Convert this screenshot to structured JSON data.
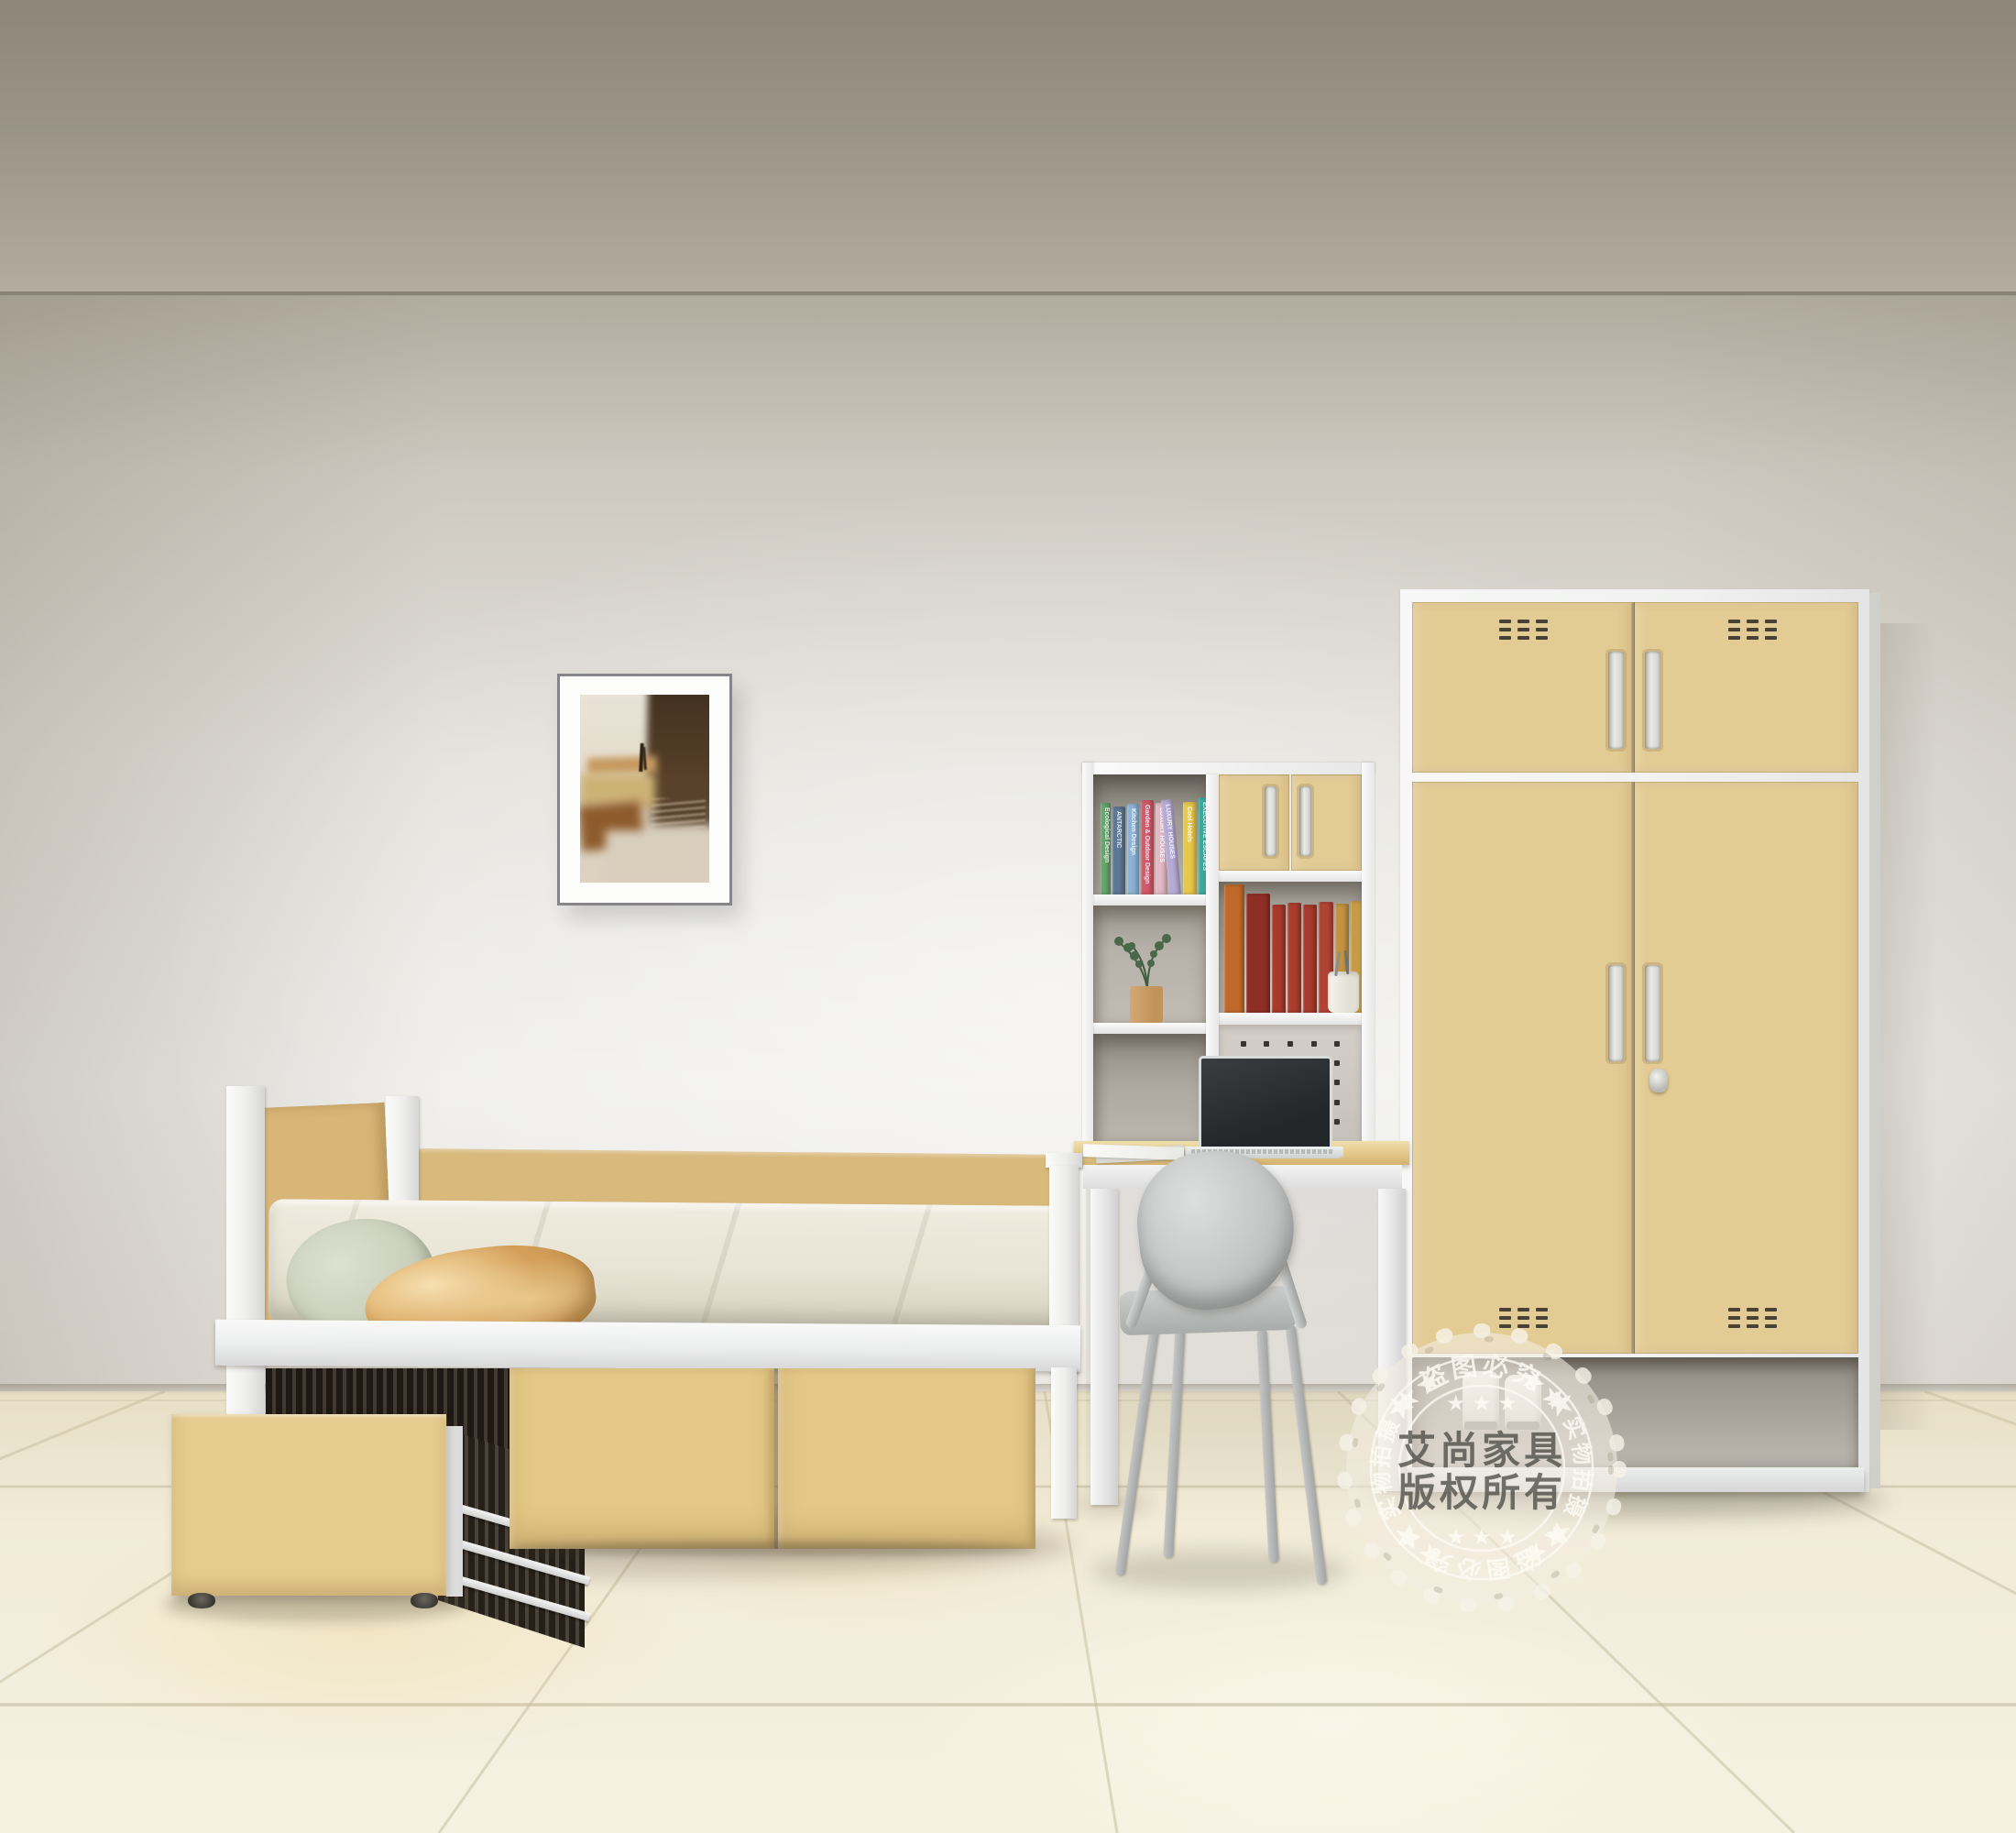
{
  "stamp": {
    "brand": "艾尚家具",
    "copyright": "版权所有",
    "arc_top": "★ 盗图必究 ★",
    "arc_right": "★★ 实物拍摄 ★★",
    "arc_bottom": "★ 盗图必究 ★",
    "arc_left": "★★ 实物拍摄 ★★",
    "stars_top": "★ ★ ★",
    "stars_bottom": "★ ★ ★"
  },
  "shelf_books": [
    {
      "title": "Ecological Design",
      "color": "#64a86e",
      "w": 11,
      "h": 100
    },
    {
      "title": "ANTARCTIC",
      "color": "#5d7894",
      "w": 14,
      "h": 96
    },
    {
      "title": "Kitchen Design",
      "color": "#8fb3d6",
      "w": 13,
      "h": 99
    },
    {
      "title": "Garden & Outdoor Design",
      "color": "#d25a6c",
      "w": 14,
      "h": 103
    },
    {
      "title": "LUXURY HOUSES",
      "color": "#e4b9c6",
      "w": 13,
      "h": 100
    },
    {
      "title": "LUXURY HOUSES",
      "color": "#b7abd6",
      "w": 13,
      "h": 104,
      "lean": -5
    },
    {
      "title": "Cool Hotels",
      "color": "#e7c84b",
      "w": 15,
      "h": 101
    },
    {
      "title": "EXECUTIVE ESCAPES",
      "color": "#3da89a",
      "w": 14,
      "h": 106
    }
  ],
  "classic_books": [
    {
      "color": "#c06a2a",
      "w": 22,
      "h": 140
    },
    {
      "color": "#8e2f26",
      "w": 26,
      "h": 130
    },
    {
      "color": "#a63a2c",
      "w": 15,
      "h": 118,
      "bands": true
    },
    {
      "color": "#ab3d2e",
      "w": 15,
      "h": 120,
      "bands": true
    },
    {
      "color": "#a63a2c",
      "w": 15,
      "h": 118,
      "bands": true
    },
    {
      "color": "#b04434",
      "w": 16,
      "h": 121,
      "bands": true
    },
    {
      "color": "#c3923f",
      "w": 15,
      "h": 119,
      "bands": true
    },
    {
      "color": "#c79a45",
      "w": 16,
      "h": 122,
      "bands": true
    }
  ],
  "grids": {
    "vent": {
      "cols": 3,
      "rows": 3,
      "count": 9
    },
    "pegboard": {
      "cols": 5,
      "rows": 5,
      "count": 25
    }
  },
  "palette": {
    "wood": "#e0c48b",
    "wood_light": "#eed9a6",
    "wood_dark": "#c9a96b",
    "frame_white": "#f2f3f2",
    "wall_top": "#b2ab9e",
    "wall_bright": "#eeedea",
    "ceiling_top": "#8e8679",
    "floor_base": "#f1ebd7",
    "grout": "#c8bfa3",
    "mattress": "#e9e7da",
    "pillow_sage": "#ccd1bf",
    "pillow_gold": "#d9a963",
    "chair_gray": "#c6c8c7",
    "laptop_screen": "#2e3133",
    "cubby_interior": "#b7b3ab",
    "trundle_dark": "#3a332b",
    "stamp_cream": "#f3eee2",
    "stamp_text_dark": "#585650"
  }
}
